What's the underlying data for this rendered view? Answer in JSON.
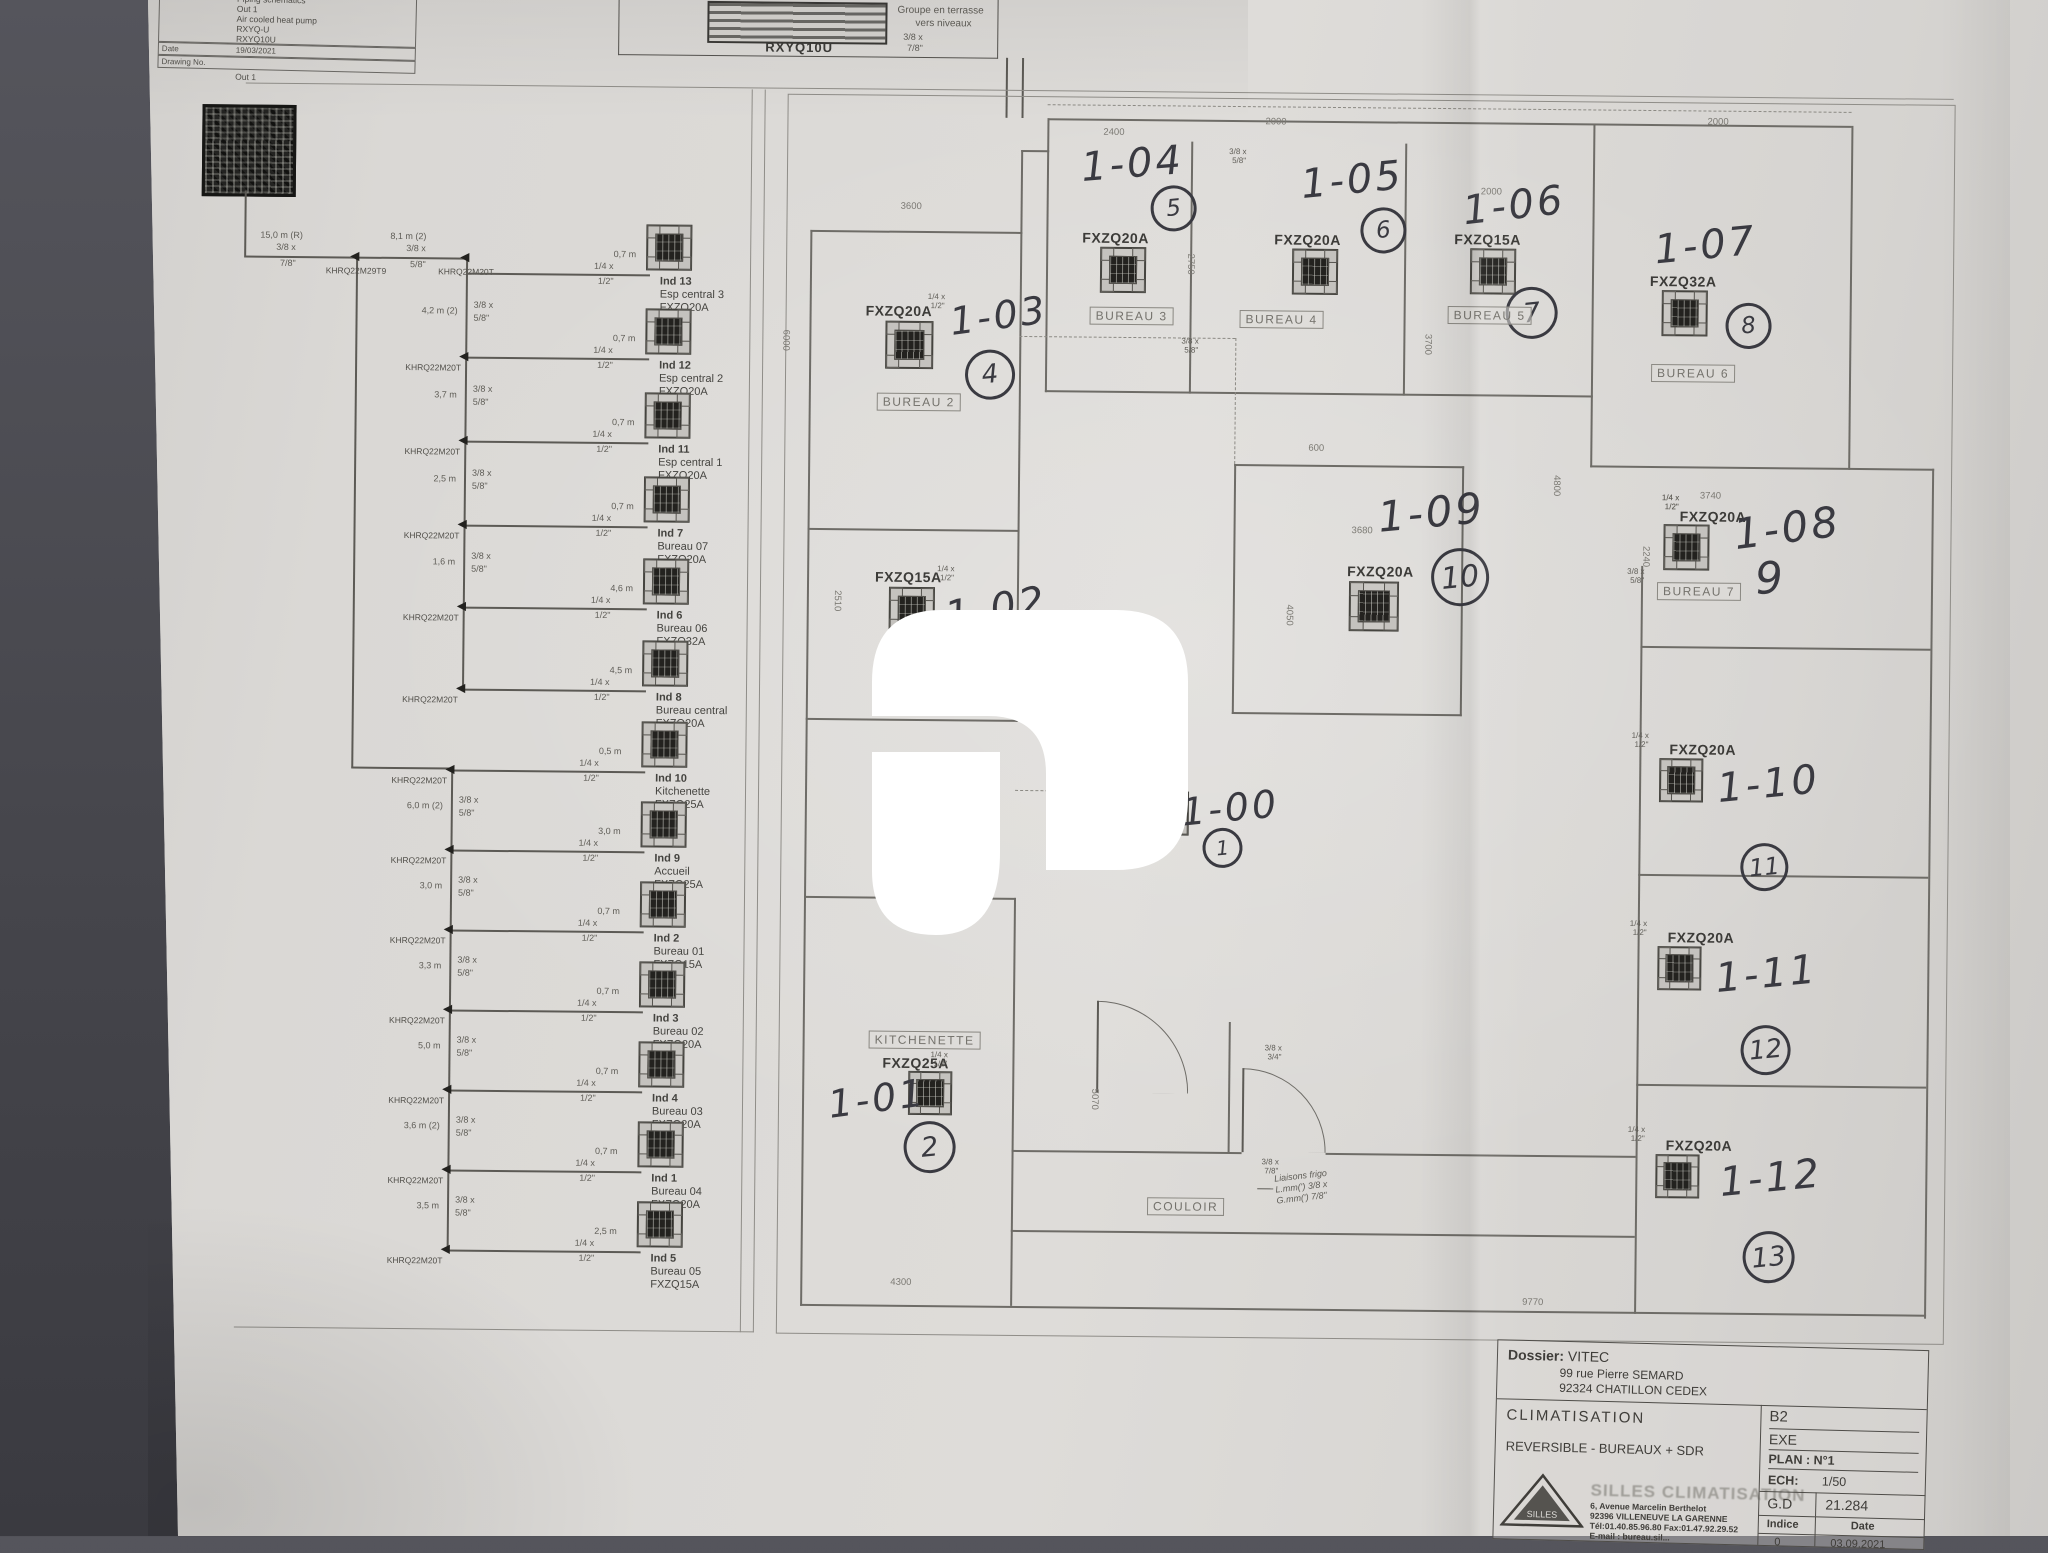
{
  "top_title_block": {
    "title_label": "Title",
    "title_lines": [
      "Piping schematics",
      "Out 1",
      "Air cooled heat pump",
      "RXYQ-U",
      "RXYQ10U"
    ],
    "date_label": "Date",
    "date_value": "19/03/2021",
    "drawing_label": "Drawing No.",
    "below": "Out 1"
  },
  "outdoor_box": {
    "model": "RXYQ10U",
    "note_line1": "Groupe en terrasse",
    "note_line2": "vers niveaux",
    "pipe_s1": "3/8 x",
    "pipe_s2": "7/8\""
  },
  "schematic": {
    "feed_len": "15,0 m (R)",
    "feed_s1": "3/8 x",
    "feed_s2": "7/8\"",
    "first_joint": "KHRQ22M29T9",
    "joint_model": "KHRQ22M20T",
    "second_seg_len": "8,1 m (2)",
    "chain_s1": "3/8 x",
    "chain_s2": "5/8\"",
    "branch_s1": "1/4 x",
    "branch_s2": "1/2\"",
    "upper_segs": [
      "4,2 m (2)",
      "3,7 m",
      "2,5 m",
      "1,6 m",
      ""
    ],
    "lower_segs": [
      "6,0 m (2)",
      "3,0 m",
      "3,3 m",
      "5,0 m",
      "3,6 m (2)",
      "3,5 m"
    ],
    "units": [
      {
        "ind": "Ind 13",
        "name": "Esp central 3",
        "model": "FXZQ20A",
        "len": "0,7 m"
      },
      {
        "ind": "Ind 12",
        "name": "Esp central 2",
        "model": "FXZQ20A",
        "len": "0,7 m"
      },
      {
        "ind": "Ind 11",
        "name": "Esp central 1",
        "model": "FXZQ20A",
        "len": "0,7 m"
      },
      {
        "ind": "Ind 7",
        "name": "Bureau 07",
        "model": "FXZQ20A",
        "len": "0,7 m"
      },
      {
        "ind": "Ind 6",
        "name": "Bureau 06",
        "model": "FXZQ32A",
        "len": "4,6 m"
      },
      {
        "ind": "Ind 8",
        "name": "Bureau central",
        "model": "FXZQ20A",
        "len": "4,5 m"
      },
      {
        "ind": "Ind 10",
        "name": "Kitchenette",
        "model": "FXZQ25A",
        "len": "0,5 m"
      },
      {
        "ind": "Ind 9",
        "name": "Accueil",
        "model": "FXZQ25A",
        "len": "3,0 m"
      },
      {
        "ind": "Ind 2",
        "name": "Bureau 01",
        "model": "FXZQ15A",
        "len": "0,7 m"
      },
      {
        "ind": "Ind 3",
        "name": "Bureau 02",
        "model": "FXZQ20A",
        "len": "0,7 m"
      },
      {
        "ind": "Ind 4",
        "name": "Bureau 03",
        "model": "FXZQ20A",
        "len": "0,7 m"
      },
      {
        "ind": "Ind 1",
        "name": "Bureau 04",
        "model": "FXZQ20A",
        "len": "0,7 m"
      },
      {
        "ind": "Ind 5",
        "name": "Bureau 05",
        "model": "FXZQ15A",
        "len": "2,5 m"
      }
    ]
  },
  "plan": {
    "units": [
      {
        "tag": "1-03",
        "model": "FXZQ20A",
        "circle": "4",
        "room": "BUREAU 2"
      },
      {
        "tag": "1-04",
        "model": "FXZQ20A",
        "circle": "5",
        "room": "BUREAU 3"
      },
      {
        "tag": "1-05",
        "model": "FXZQ20A",
        "circle": "6",
        "room": "BUREAU 4"
      },
      {
        "tag": "1-06",
        "model": "FXZQ15A",
        "circle": "7",
        "room": "BUREAU 5"
      },
      {
        "tag": "1-07",
        "model": "FXZQ32A",
        "circle": "8",
        "room": "BUREAU 6"
      },
      {
        "tag": "1-08",
        "model": "FXZQ20A",
        "plain": "9",
        "room": "BUREAU 7"
      },
      {
        "tag": "1-09",
        "model": "FXZQ20A",
        "circle": "10"
      },
      {
        "tag": "1-00",
        "model": "",
        "circle": "1"
      },
      {
        "tag": "1-01",
        "model": "FXZQ25A",
        "circle": "2",
        "room": "KITCHENETTE"
      },
      {
        "tag": "1-02",
        "model": "FXZQ15A",
        "room": "BUREAU 1"
      },
      {
        "tag": "1-10",
        "model": "FXZQ20A",
        "circle": "11"
      },
      {
        "tag": "1-11",
        "model": "FXZQ20A",
        "circle": "12"
      },
      {
        "tag": "1-12",
        "model": "FXZQ20A",
        "circle": "13"
      }
    ],
    "unit_pipe_s1": "1/4 x",
    "unit_pipe_s2": "1/2\"",
    "extra_pipes": [
      {
        "s1": "3/8 x",
        "s2": "5/8\""
      },
      {
        "s1": "3/8 x",
        "s2": "5/8\""
      },
      {
        "s1": "1/4 x",
        "s2": "1/2\""
      },
      {
        "s1": "3/8 x",
        "s2": "3/4\""
      },
      {
        "s1": "3/8 x",
        "s2": "7/8\""
      }
    ],
    "couloir": "COULOIR",
    "liaison_note": [
      "Liaisons frigo",
      "L.mm(')  3/8 x",
      "G.mm(')  7/8\""
    ],
    "dimensions": [
      "3600",
      "2400",
      "2000",
      "2000",
      "2000",
      "6000",
      "2750",
      "3700",
      "4800",
      "600",
      "3680",
      "4050",
      "2240",
      "3740",
      "2510",
      "3600",
      "5070",
      "4300",
      "9770"
    ]
  },
  "bottom_title_block": {
    "dossier_label": "Dossier:",
    "dossier_name": "VITEC",
    "address1": "99 rue Pierre SEMARD",
    "address2": "92324 CHATILLON CEDEX",
    "subject1": "CLIMATISATION",
    "subject2": "REVERSIBLE  -  BUREAUX  +  SDR",
    "company_big": "SILLES CLIMATISATION",
    "company_addr1": "6, Avenue Marcelin Berthelot",
    "company_addr2": "92396 VILLENEUVE LA GARENNE",
    "company_addr3": "Tél:01.40.85.96.80  Fax:01.47.92.29.52",
    "company_addr4": "E-mail : bureau.sil...",
    "cell_b2": "B2",
    "cell_exe": "EXE",
    "cell_plan": "PLAN : N°1",
    "cell_ech_label": "ECH:",
    "cell_ech_value": "1/50",
    "cell_gd_label": "G.D",
    "cell_gd_value": "21.284",
    "cell_indice_label": "Indice",
    "cell_date_label": "Date",
    "cell_indice_value": "0",
    "cell_date_value": "03.09.2021"
  }
}
